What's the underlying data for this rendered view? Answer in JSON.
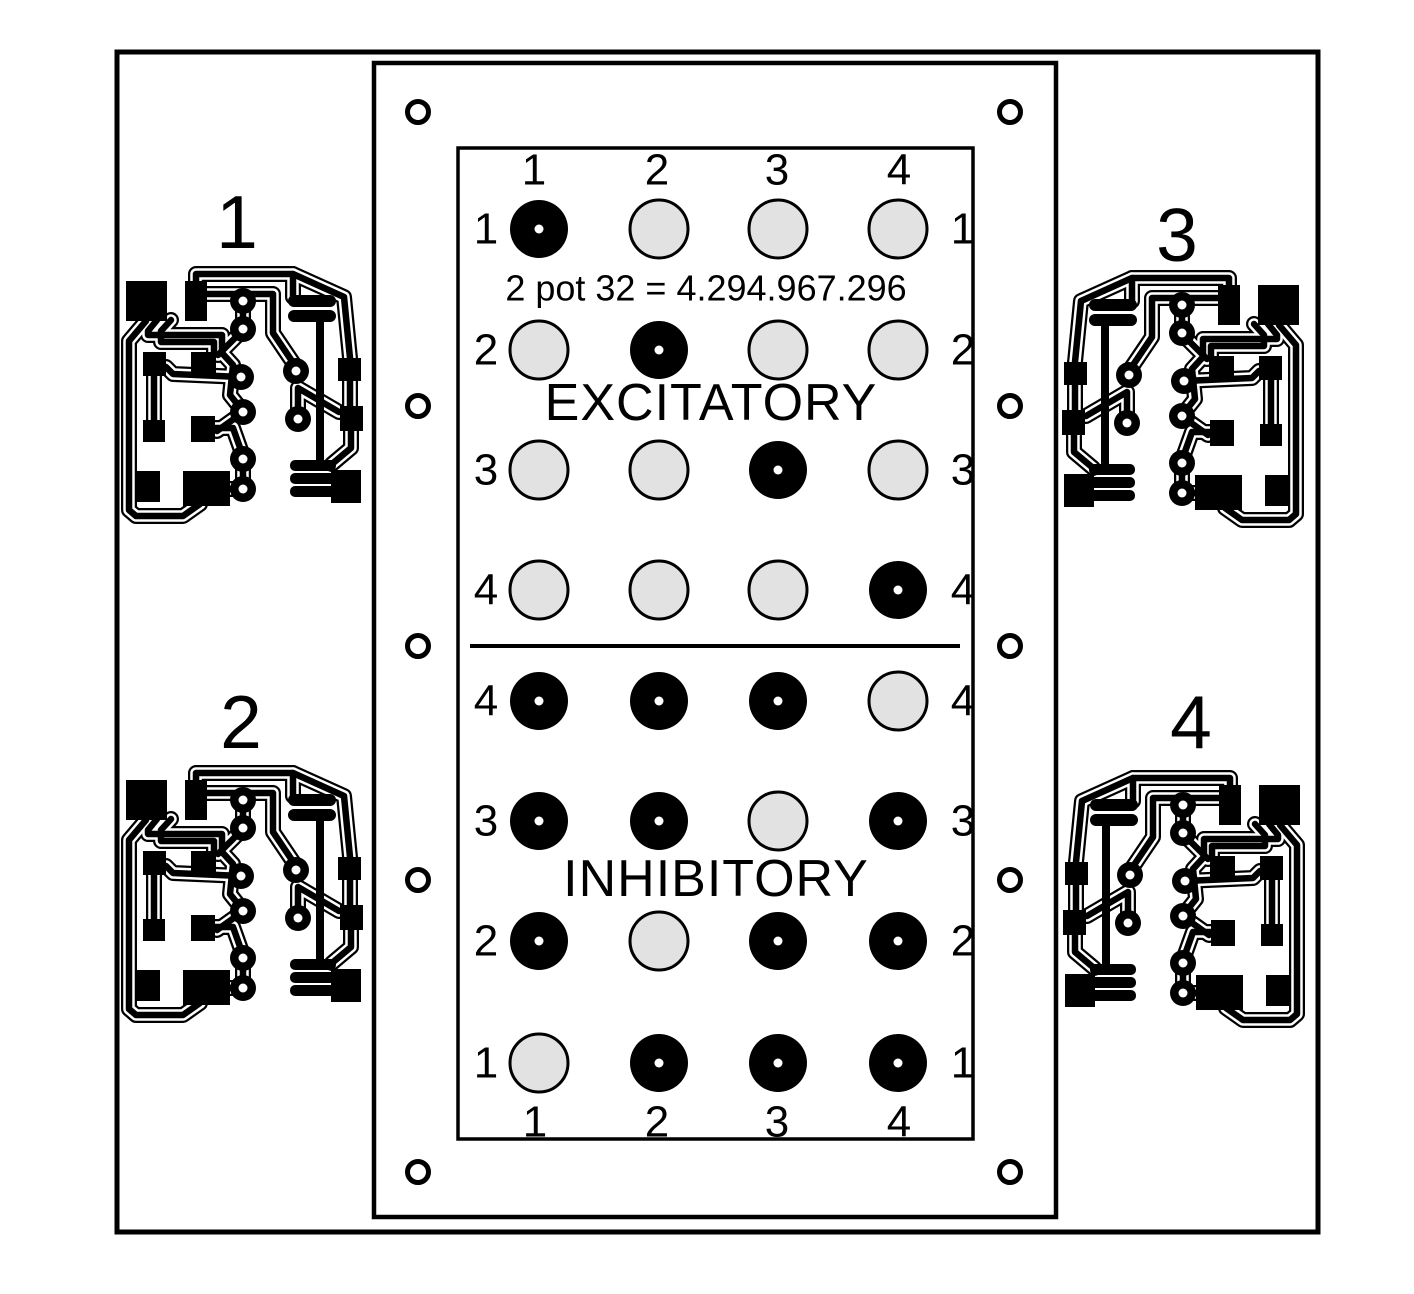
{
  "diagram": {
    "matrix_panel": {
      "excitatory": {
        "title": "EXCITATORY",
        "formula": "2 pot 32 = 4.294.967.296",
        "column_labels": [
          "1",
          "2",
          "3",
          "4"
        ],
        "row_labels": [
          "1",
          "2",
          "3",
          "4"
        ],
        "cells": [
          [
            1,
            0,
            0,
            0
          ],
          [
            0,
            1,
            0,
            0
          ],
          [
            0,
            0,
            1,
            0
          ],
          [
            0,
            0,
            0,
            1
          ]
        ]
      },
      "inhibitory": {
        "title": "INHIBITORY",
        "column_labels": [
          "1",
          "2",
          "3",
          "4"
        ],
        "row_labels": [
          "4",
          "3",
          "2",
          "1"
        ],
        "cells": [
          [
            1,
            1,
            1,
            0
          ],
          [
            1,
            1,
            0,
            1
          ],
          [
            1,
            0,
            1,
            1
          ],
          [
            0,
            1,
            1,
            1
          ]
        ]
      }
    },
    "pcb_modules": [
      {
        "label": "1",
        "position": "top-left"
      },
      {
        "label": "2",
        "position": "bottom-left"
      },
      {
        "label": "3",
        "position": "top-right"
      },
      {
        "label": "4",
        "position": "bottom-right"
      }
    ],
    "colors": {
      "ink": "#000000",
      "background": "#ffffff",
      "open_cell_fill": "#e2e2e2",
      "filled_cell_fill": "#000000"
    }
  }
}
